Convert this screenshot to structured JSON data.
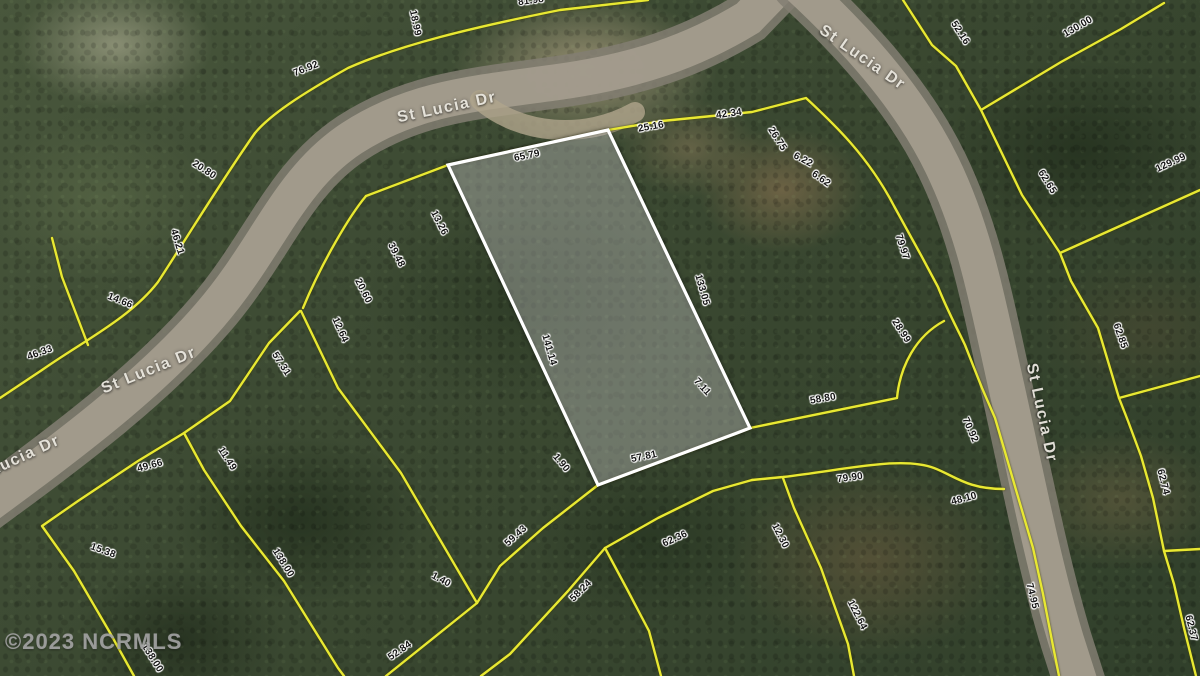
{
  "watermark": "©2023 NCRMLS",
  "colors": {
    "lot_line": "#e8e832",
    "parcel_outline": "#ffffff",
    "parcel_fill": "rgba(255,255,255,0.30)",
    "road": "#a39c8d",
    "forest": "#3a4931",
    "dimension_text": "#141414",
    "street_text": "#e9e6de"
  },
  "map": {
    "street_labels": [
      {
        "text": "St Lucia Dr",
        "x": 447,
        "y": 108,
        "rot": -12
      },
      {
        "text": "St Lucia Dr",
        "x": 862,
        "y": 58,
        "rot": 35
      },
      {
        "text": "St Lucia Dr",
        "x": 149,
        "y": 371,
        "rot": -22
      },
      {
        "text": "Lucia Dr",
        "x": 25,
        "y": 456,
        "rot": -25
      },
      {
        "text": "St Lucia Dr",
        "x": 1041,
        "y": 413,
        "rot": 78
      }
    ],
    "dimension_labels": [
      {
        "text": "81.98",
        "x": 531,
        "y": 1,
        "rot": -8
      },
      {
        "text": "18.99",
        "x": 415,
        "y": 23,
        "rot": 78
      },
      {
        "text": "76.92",
        "x": 306,
        "y": 69,
        "rot": -22
      },
      {
        "text": "20.80",
        "x": 204,
        "y": 170,
        "rot": 33
      },
      {
        "text": "46.21",
        "x": 177,
        "y": 242,
        "rot": 73
      },
      {
        "text": "14.66",
        "x": 120,
        "y": 301,
        "rot": 22
      },
      {
        "text": "46.33",
        "x": 40,
        "y": 353,
        "rot": -20
      },
      {
        "text": "65.79",
        "x": 527,
        "y": 156,
        "rot": -12
      },
      {
        "text": "25.16",
        "x": 651,
        "y": 127,
        "rot": -10
      },
      {
        "text": "42.34",
        "x": 729,
        "y": 114,
        "rot": -8
      },
      {
        "text": "26.75",
        "x": 777,
        "y": 139,
        "rot": 57
      },
      {
        "text": "6.22",
        "x": 803,
        "y": 160,
        "rot": 28
      },
      {
        "text": "6.62",
        "x": 821,
        "y": 179,
        "rot": 35
      },
      {
        "text": "79.97",
        "x": 902,
        "y": 247,
        "rot": 72
      },
      {
        "text": "52.16",
        "x": 960,
        "y": 33,
        "rot": 57
      },
      {
        "text": "130.00",
        "x": 1078,
        "y": 27,
        "rot": -30
      },
      {
        "text": "129.99",
        "x": 1171,
        "y": 163,
        "rot": -25
      },
      {
        "text": "62.65",
        "x": 1047,
        "y": 182,
        "rot": 58
      },
      {
        "text": "13.26",
        "x": 439,
        "y": 223,
        "rot": 63
      },
      {
        "text": "39.48",
        "x": 396,
        "y": 255,
        "rot": 63
      },
      {
        "text": "20.60",
        "x": 363,
        "y": 291,
        "rot": 63
      },
      {
        "text": "12.64",
        "x": 340,
        "y": 330,
        "rot": 66
      },
      {
        "text": "57.31",
        "x": 281,
        "y": 364,
        "rot": 57
      },
      {
        "text": "133.05",
        "x": 702,
        "y": 290,
        "rot": 74
      },
      {
        "text": "141.14",
        "x": 549,
        "y": 350,
        "rot": 74
      },
      {
        "text": "7.11",
        "x": 702,
        "y": 387,
        "rot": 47
      },
      {
        "text": "28.99",
        "x": 901,
        "y": 331,
        "rot": 57
      },
      {
        "text": "62.85",
        "x": 1120,
        "y": 336,
        "rot": 71
      },
      {
        "text": "58.80",
        "x": 823,
        "y": 399,
        "rot": -10
      },
      {
        "text": "70.92",
        "x": 970,
        "y": 430,
        "rot": 66
      },
      {
        "text": "1.90",
        "x": 561,
        "y": 463,
        "rot": 50
      },
      {
        "text": "57.81",
        "x": 644,
        "y": 457,
        "rot": -12
      },
      {
        "text": "49.66",
        "x": 150,
        "y": 466,
        "rot": -15
      },
      {
        "text": "11.49",
        "x": 227,
        "y": 459,
        "rot": 57
      },
      {
        "text": "15.38",
        "x": 103,
        "y": 551,
        "rot": 20
      },
      {
        "text": "138.00",
        "x": 283,
        "y": 563,
        "rot": 58
      },
      {
        "text": "138.00",
        "x": 152,
        "y": 658,
        "rot": 58
      },
      {
        "text": "59.43",
        "x": 516,
        "y": 536,
        "rot": -42
      },
      {
        "text": "1.40",
        "x": 441,
        "y": 580,
        "rot": 28
      },
      {
        "text": "52.84",
        "x": 400,
        "y": 651,
        "rot": -35
      },
      {
        "text": "58.24",
        "x": 581,
        "y": 591,
        "rot": -45
      },
      {
        "text": "62.36",
        "x": 675,
        "y": 539,
        "rot": -25
      },
      {
        "text": "79.90",
        "x": 850,
        "y": 478,
        "rot": -8
      },
      {
        "text": "12.30",
        "x": 780,
        "y": 536,
        "rot": 63
      },
      {
        "text": "122.64",
        "x": 857,
        "y": 615,
        "rot": 63
      },
      {
        "text": "48.10",
        "x": 964,
        "y": 499,
        "rot": -15
      },
      {
        "text": "62.74",
        "x": 1163,
        "y": 482,
        "rot": 76
      },
      {
        "text": "74.95",
        "x": 1032,
        "y": 596,
        "rot": 76
      },
      {
        "text": "62.37",
        "x": 1191,
        "y": 628,
        "rot": 76
      }
    ]
  }
}
